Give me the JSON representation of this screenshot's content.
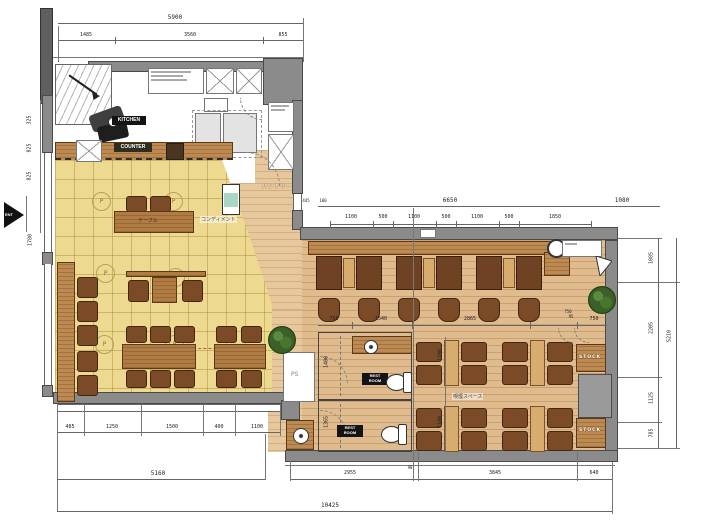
{
  "labels": {
    "kitchen": "KITCHEN",
    "counter": "COUNTER",
    "pantry": "パントリー",
    "condiment": "コンディメント",
    "table": "テーブル",
    "smoking_space": "喫煙スペース",
    "restroom": "REST\nROOM",
    "restroom2": "REST\nROOM",
    "stock_upper": "STOCK",
    "stock_lower": "STOCK",
    "ps": "PS",
    "ent": "ENT",
    "pendant": "P"
  },
  "dims": {
    "top": {
      "overall": "5900",
      "segs": [
        "1485",
        "3560",
        "855"
      ]
    },
    "left": {
      "segs": [
        "325",
        "825",
        "825"
      ],
      "entry": "1780"
    },
    "right_top": {
      "overall": "6650",
      "end": "1080",
      "small": [
        "445",
        "100"
      ],
      "segs": [
        "1100",
        "500",
        "1100",
        "500",
        "1100",
        "500",
        "1850"
      ]
    },
    "right": {
      "overall": "5210",
      "segs": [
        "1085",
        "2205",
        "1125",
        "785"
      ],
      "bench": "750"
    },
    "mid": {
      "segs": [
        "750",
        "1540",
        "2865",
        "95",
        "750"
      ]
    },
    "inner": {
      "v1": "1100",
      "v2": "1100",
      "v3": "1400",
      "v4": "1365"
    },
    "bottom_left": {
      "overall": "5160",
      "segs": [
        "485",
        "1250",
        "1500",
        "400",
        "1100"
      ]
    },
    "bottom_right": {
      "segs": [
        "2955",
        "90",
        "3845",
        "640"
      ]
    },
    "overall_width": "10425"
  },
  "colors": {
    "wall": "#8b8b8b",
    "tile_floor": "#edd98f",
    "wood_floor": "#dfbb8d",
    "furniture": "#7b4b28"
  }
}
